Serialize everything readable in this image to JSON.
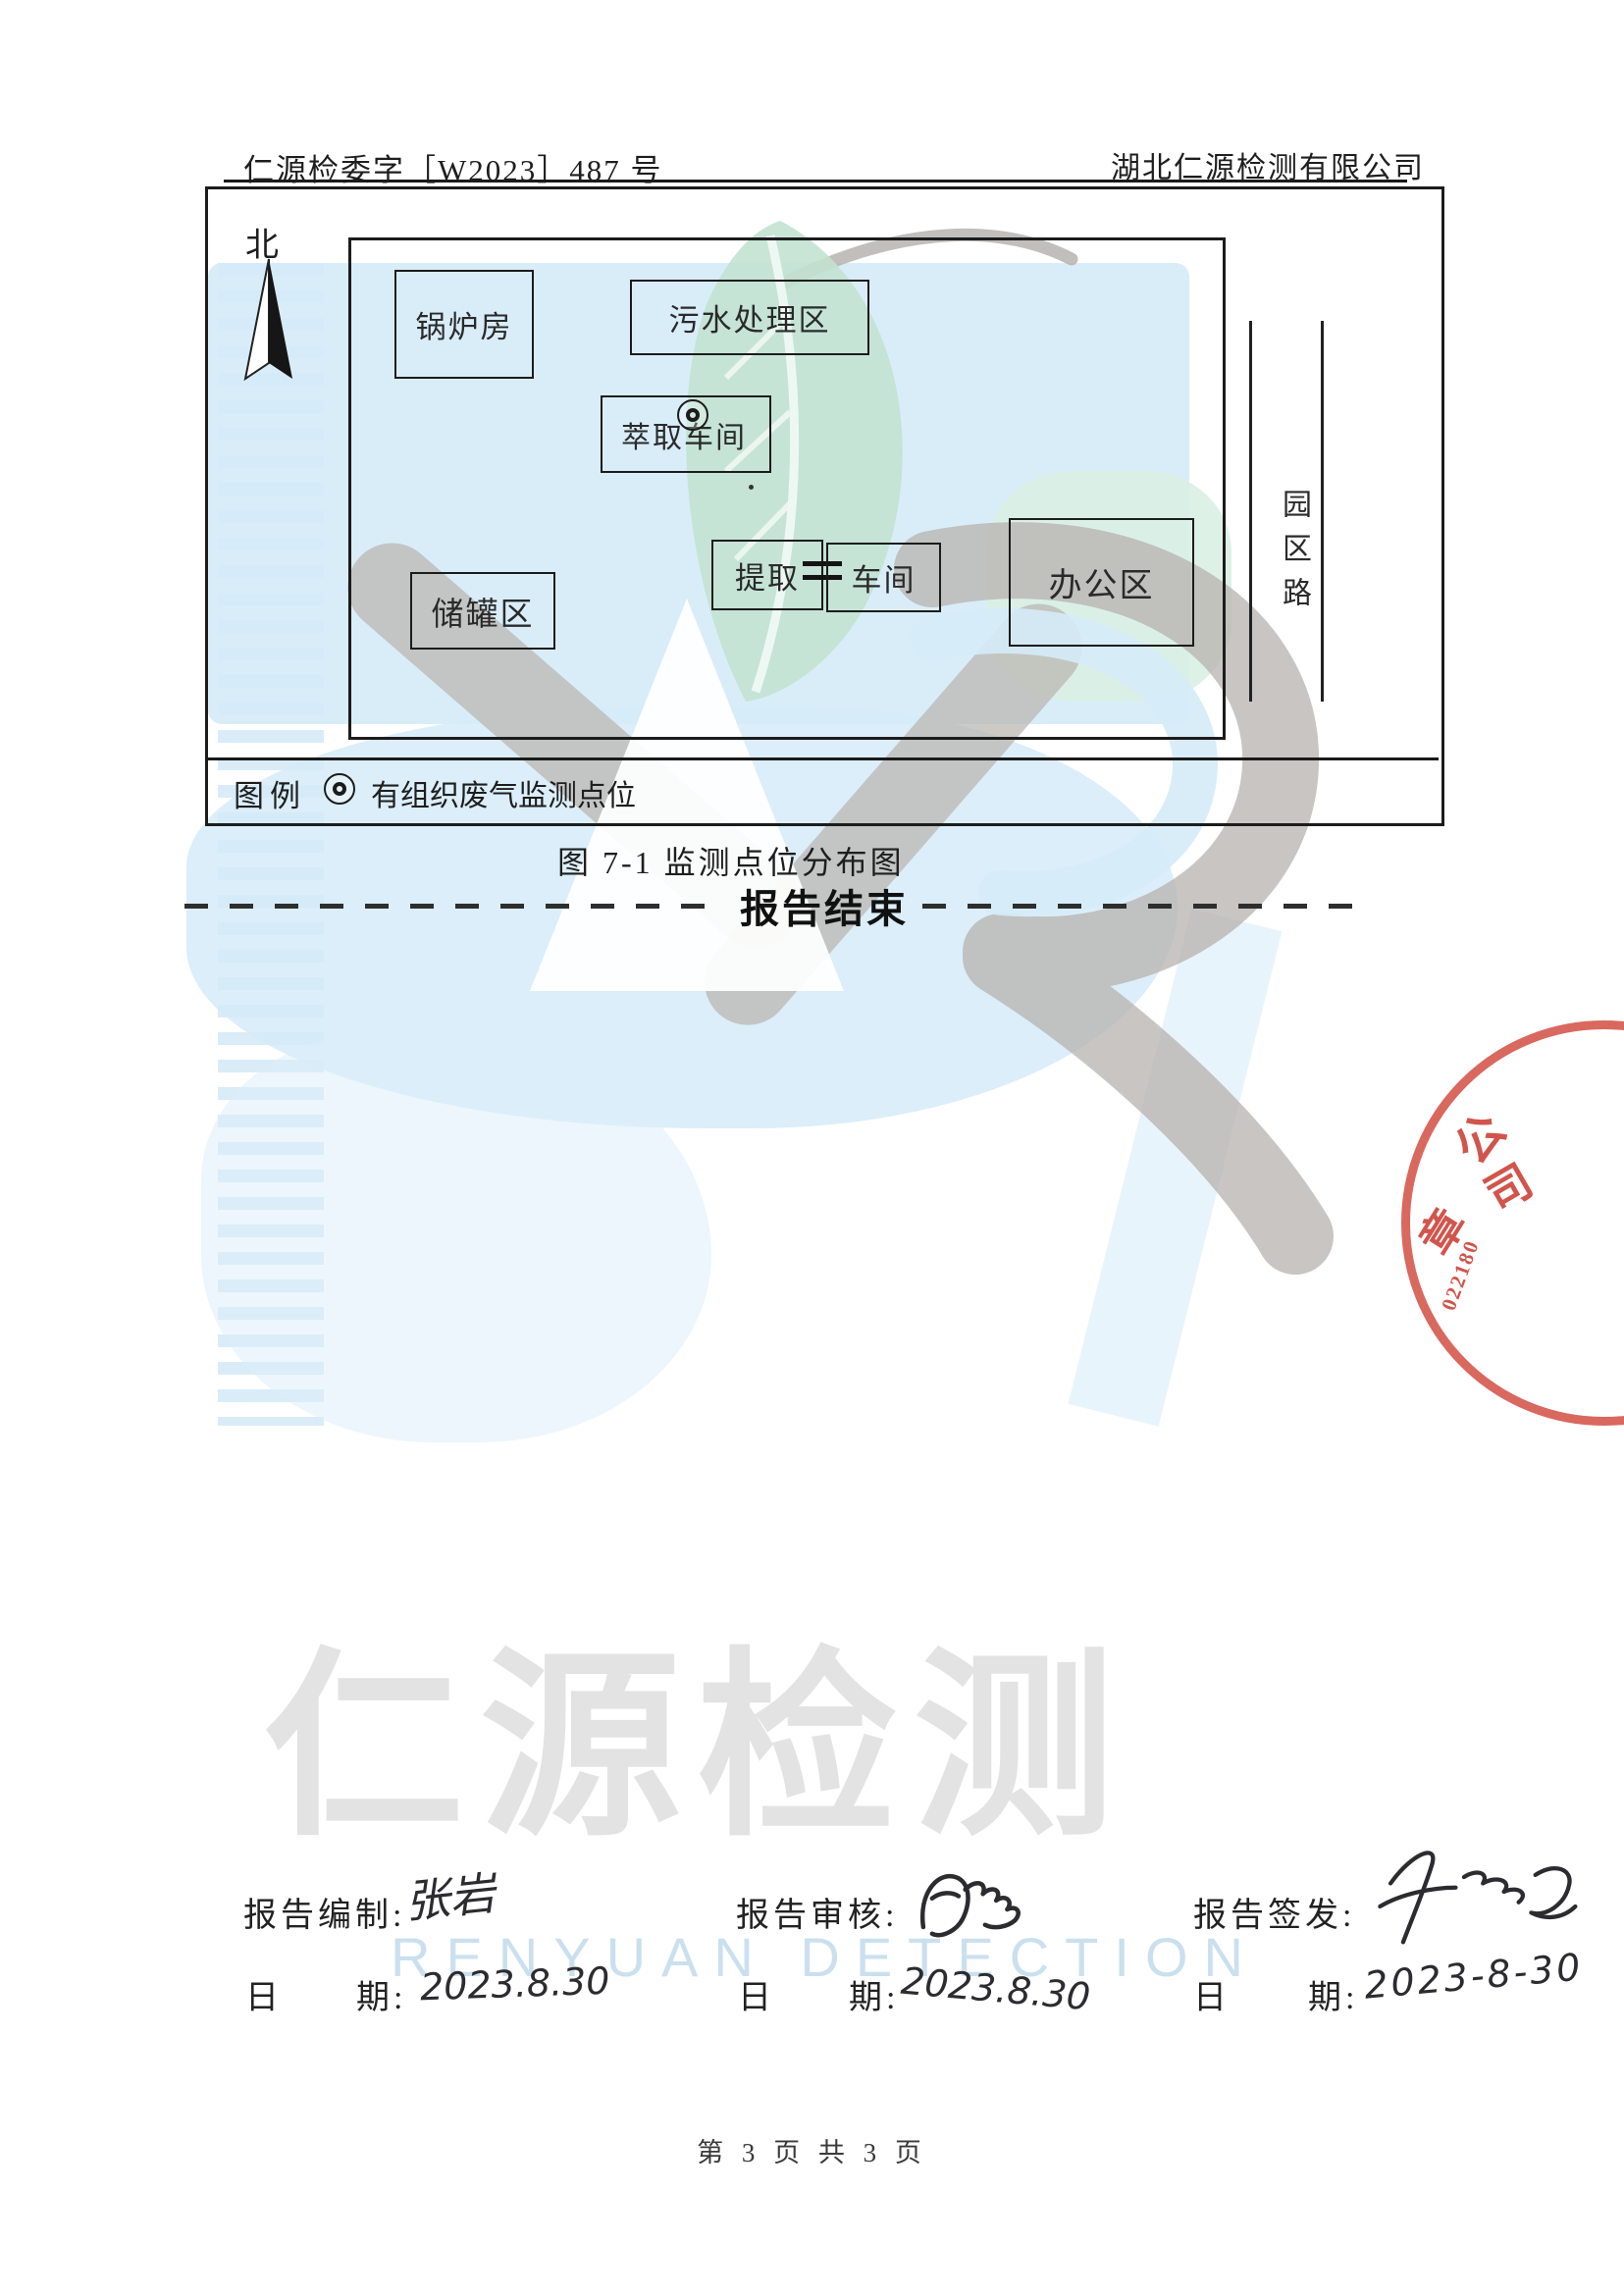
{
  "header": {
    "doc_number": "仁源检委字［W2023］487 号",
    "company": "湖北仁源检测有限公司"
  },
  "map": {
    "north": "北",
    "boxes": {
      "boiler": "锅炉房",
      "wastewater": "污水处理区",
      "cuiqu_workshop": "萃取车间",
      "tank_area": "储罐区",
      "tiqu": "提取",
      "chejian": "车间",
      "office": "办公区"
    },
    "road": "园区路",
    "legend_label": "图例",
    "legend_item": "有组织废气监测点位",
    "caption": "图 7-1  监测点位分布图"
  },
  "report_end": "报告结束",
  "watermark": {
    "cn": "仁源检测",
    "en": "RENYUAN DETECTION"
  },
  "stamp": {
    "char1": "公",
    "char2": "司",
    "char3": "章",
    "number": "022180"
  },
  "signoff": {
    "ri": "日",
    "qi": "期:",
    "cols": [
      {
        "role": "报告编制:",
        "name": "张岩",
        "date": "2023.8.30"
      },
      {
        "role": "报告审核:",
        "date": "2023.8.30"
      },
      {
        "role": "报告签发:",
        "date": "2023-8-30"
      }
    ]
  },
  "footer": "第 3 页 共 3 页"
}
